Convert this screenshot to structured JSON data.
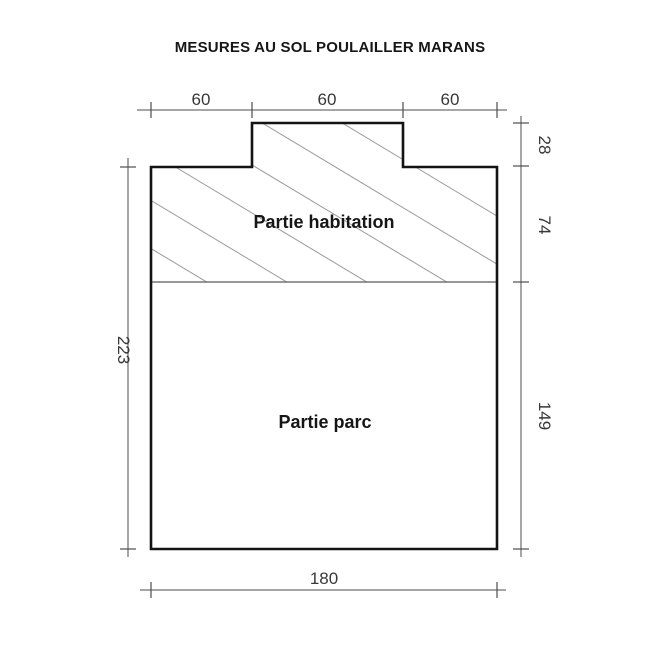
{
  "title": "MESURES AU SOL POULAILLER MARANS",
  "areas": {
    "habitation_label": "Partie habitation",
    "parc_label": "Partie parc"
  },
  "dimensions": {
    "top": [
      "60",
      "60",
      "60"
    ],
    "right": [
      "28",
      "74",
      "149"
    ],
    "left": [
      "223"
    ],
    "bottom": [
      "180"
    ]
  },
  "colors": {
    "outline": "#131313",
    "divider": "#5a5a5a",
    "hatch": "#9b9b9b",
    "dimension_line": "#4d4d4d",
    "dimension_text": "#383838",
    "label_text": "#161616",
    "background": "#ffffff"
  }
}
